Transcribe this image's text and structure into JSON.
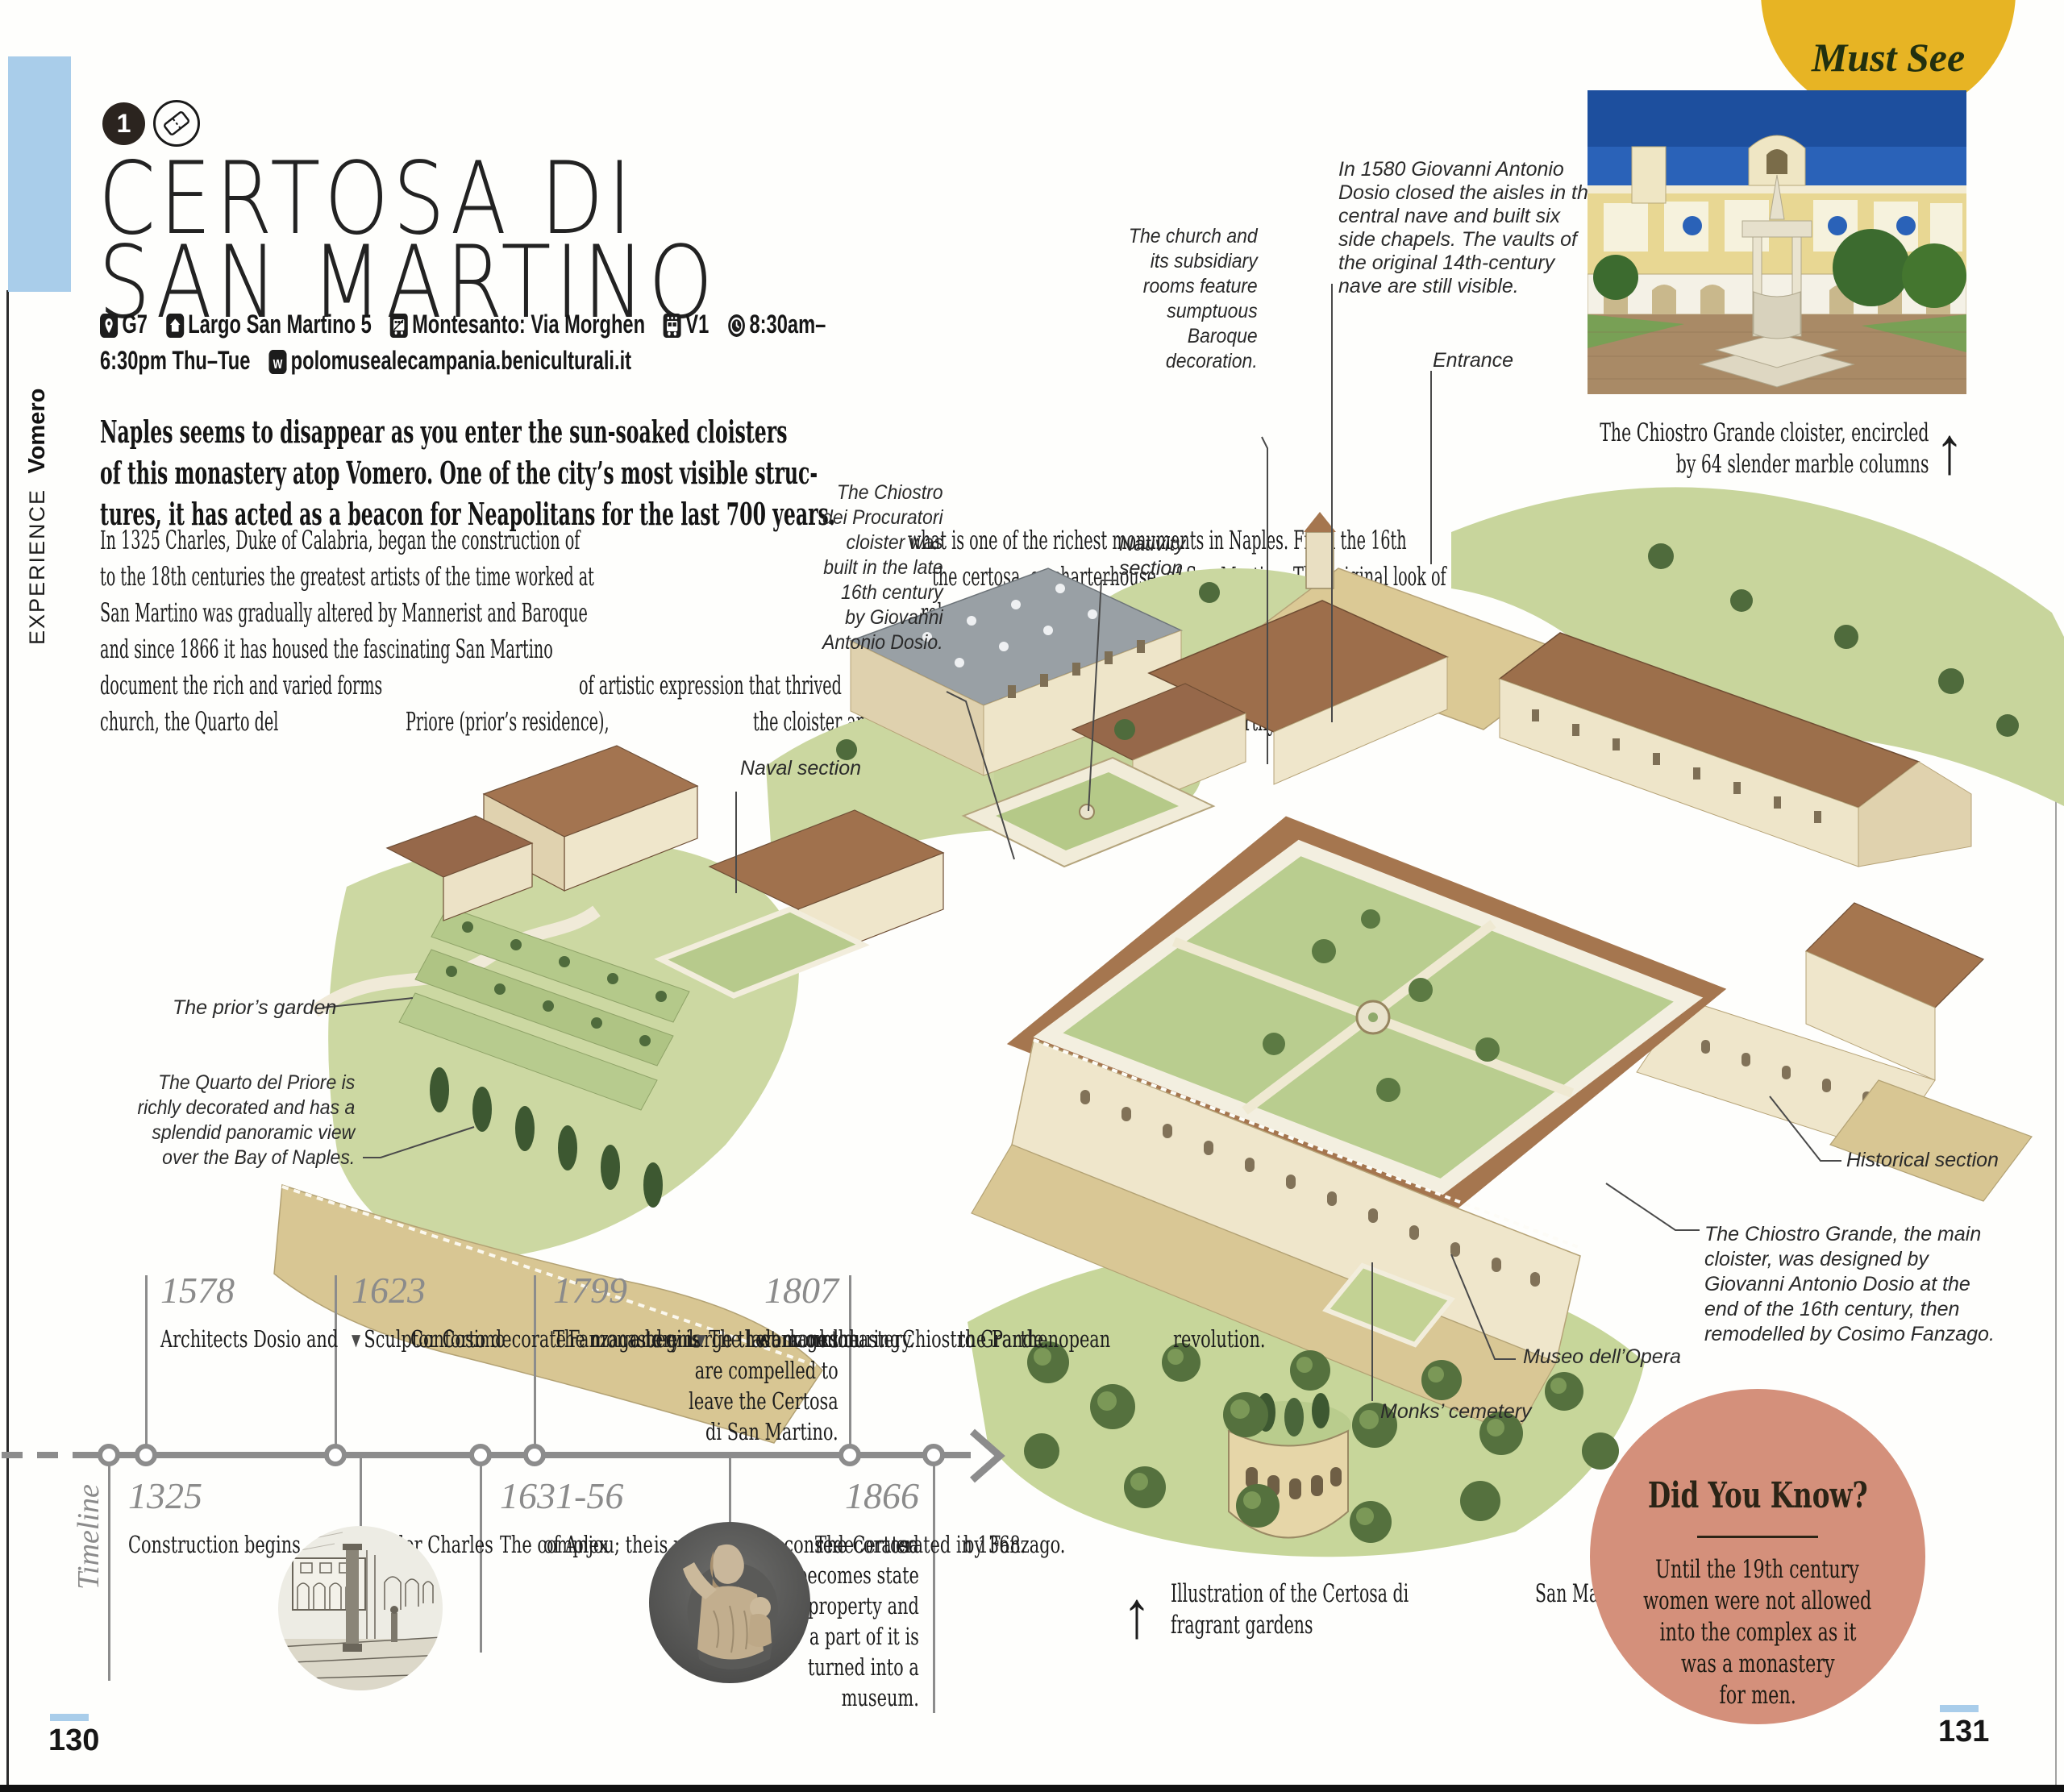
{
  "page": {
    "left_number": "130",
    "right_number": "131"
  },
  "badge": {
    "number": "1",
    "must_see": "Must See"
  },
  "sidebar": {
    "section": "EXPERIENCE",
    "area": "Vomero"
  },
  "title": {
    "line1": "CERTOSA DI",
    "line2": "SAN MARTINO"
  },
  "info": {
    "map_ref": "G7",
    "address": "Largo San Martino 5",
    "metro": "Montesanto: Via Morghen",
    "bus": "V1",
    "hours_part1": "8:30am–",
    "hours_part2": "6:30pm Thu–Tue",
    "website": "polomusealecampania.beniculturali.it"
  },
  "intro": {
    "lines": [
      "Naples seems to disappear as you enter the sun-soaked cloisters",
      "of this monastery atop Vomero. One of the city’s most visible struc-",
      "tures, it has acted as a beacon for Neapolitans for the last 700 years."
    ]
  },
  "body": {
    "lines": [
      "In 1325 Charles, Duke of Calabria, began the construction of",
      "what is one of the richest monuments in Naples. From the 16th",
      "to the 18th centuries the greatest artists of the time worked at",
      "the certosa, or charterhouse, of San Martino. The original look of",
      "San Martino was gradually altered by Mannerist and Baroque",
      "rebuilding. The French deconsecrated the monastery in 1806,",
      "and since 1866 it has housed the fascinating San Martino",
      "museum, with displays of Neapolitan art and history that",
      "document the rich and varied forms",
      "of artistic expression that thrived",
      "in Naples between the 15th",
      "and the 19th centuries. The",
      "church, the Quarto del",
      "Priore (prior’s residence),",
      "the cloister and the gar-",
      "dens are also noteworthy."
    ]
  },
  "labels": {
    "naval": "Naval section",
    "procuratori": {
      "lines": [
        "The Chiostro",
        "dei Procuratori",
        "cloister was",
        "built in the late",
        "16th century",
        "by Giovanni",
        "Antonio Dosio."
      ]
    },
    "church": {
      "lines": [
        "The church and",
        "its subsidiary",
        "rooms feature",
        "sumptuous",
        "Baroque",
        "decoration."
      ]
    },
    "nativity": {
      "lines": [
        "Nativity",
        "section"
      ]
    },
    "dosio_1580": {
      "lines": [
        "In 1580 Giovanni Antonio",
        "Dosio closed the aisles in the",
        "central nave and built six",
        "side chapels. The vaults of",
        "the original 14th-century",
        "nave are still visible."
      ]
    },
    "entrance": "Entrance",
    "priors_garden": "The prior’s garden",
    "quarto": {
      "lines": [
        "The Quarto del Priore is",
        "richly decorated and has a",
        "splendid panoramic view",
        "over the Bay of Naples."
      ]
    },
    "historical": "Historical section",
    "chiostro_grande": {
      "lines": [
        "The Chiostro Grande, the main",
        "cloister, was designed by",
        "Giovanni Antonio Dosio at the",
        "end of the 16th century, then",
        "remodelled by Cosimo Fanzago."
      ]
    },
    "museo": "Museo dell’Opera",
    "monks": "Monks’ cemetery"
  },
  "photo_caption": {
    "arrow": "↑",
    "lines": [
      "The Chiostro Grande cloister, encircled",
      "by 64 slender marble columns"
    ]
  },
  "illustration_caption": {
    "arrow": "↑",
    "lines": [
      "Illustration of the Certosa di",
      "San Martino, set in lush and",
      "fragrant gardens"
    ]
  },
  "timeline": {
    "heading": "Timeline",
    "marker": "▼",
    "top": [
      {
        "year": "1578",
        "lines": [
          "Architects Dosio and",
          "Conforto decorate",
          "and enlarge the",
          "monastery."
        ]
      },
      {
        "year": "1623",
        "lines": [
          "Sculptor Cosimo",
          "Fanzago begins",
          "work on the",
          "Chiostro Grande."
        ]
      },
      {
        "year": "1799",
        "lines": [
          "The monastery is",
          "damaged during",
          "the Parthenopean",
          "revolution."
        ]
      },
      {
        "year": "1807",
        "lines": [
          "The last monks",
          "are compelled to",
          "leave the Certosa",
          "di San Martino."
        ]
      }
    ],
    "bottom": [
      {
        "year": "1325",
        "lines": [
          "Construction begins",
          "under Charles",
          "of Anjou; the",
          "church is conse-",
          "crated in 1368."
        ]
      },
      {
        "year": "1631-56",
        "lines": [
          "The complex",
          "is rebuilt and",
          "redecorated",
          "by Fanzago."
        ]
      },
      {
        "year": "1866",
        "lines": [
          "The Certosa",
          "becomes state",
          "property and",
          "a part of it is",
          "turned into a",
          "museum."
        ]
      }
    ]
  },
  "did_you_know": {
    "title": "Did You Know?",
    "lines": [
      "Until the 19th century",
      "women were not allowed",
      "into the complex as it",
      "was a monastery",
      "for men."
    ]
  },
  "colors": {
    "accent_blue": "#a9cdea",
    "must_see_yellow": "#e7b424",
    "dyk_pink": "#d4907b",
    "timeline_gray": "#8c8c8c",
    "illustration_green": "#c7d69a"
  }
}
